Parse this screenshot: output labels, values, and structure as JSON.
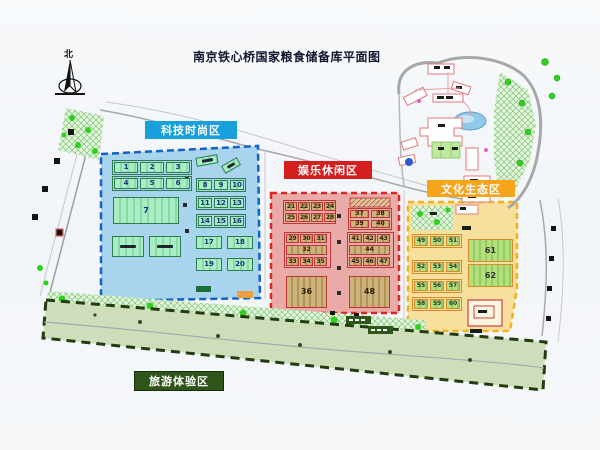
{
  "title": "南京铁心桥国家粮食储备库平面图",
  "compass": {
    "label": "北"
  },
  "map_colors": {
    "tech_zone_fill": "#a8d4ee",
    "tech_border": "#1461c8",
    "tech_accent": "#18a0dc",
    "fun_zone_fill": "#e9aaa8",
    "fun_border": "#e02424",
    "fun_accent": "#d51e1e",
    "culture_zone_fill": "#f7df9e",
    "culture_border": "#f2b21c",
    "culture_accent": "#f6a41c",
    "tour_zone_fill": "#cfdeba",
    "tour_border": "#223c10",
    "tour_accent": "#2e561b",
    "block_green": "#a9eec3",
    "block_tan": "#ccb37b",
    "pond_blue": "#8fc8e8",
    "tree_green": "#2fd11f"
  },
  "zones": {
    "tech": {
      "label": "科技时尚区",
      "accent": "#18a0dc",
      "groups": {
        "row1": [
          "1",
          "2",
          "3"
        ],
        "row2": [
          "4",
          "5",
          "6"
        ],
        "big": [
          "7"
        ],
        "special": [
          "",
          ""
        ],
        "r8": [
          "8",
          "9",
          "10"
        ],
        "r11": [
          "11",
          "12",
          "13"
        ],
        "r14": [
          "14",
          "15",
          "16"
        ],
        "r17": [
          "17",
          "18"
        ],
        "r19": [
          "19",
          "20"
        ],
        "tilt1": [
          ""
        ],
        "tilt2": [
          ""
        ]
      }
    },
    "fun": {
      "label": "娱乐休闲区",
      "accent": "#d51e1e",
      "groups": {
        "tl1": [
          "21",
          "22",
          "23",
          "24"
        ],
        "tl2": [
          "25",
          "26",
          "27",
          "28"
        ],
        "tr1": [
          "37",
          "38"
        ],
        "tr2": [
          "39",
          "40"
        ],
        "ml1": [
          "29",
          "30",
          "31"
        ],
        "ml2": [
          "32"
        ],
        "ml3": [
          "33",
          "34",
          "35"
        ],
        "mr1": [
          "41",
          "42",
          "43"
        ],
        "mr2": [
          "44"
        ],
        "mr3": [
          "45",
          "46",
          "47"
        ],
        "b36": [
          "36"
        ],
        "b48": [
          "48"
        ]
      }
    },
    "culture": {
      "label": "文化生态区",
      "accent": "#f6a41c",
      "groups": {
        "r1": [
          "49",
          "50",
          "51"
        ],
        "r2": [
          "52",
          "53",
          "54"
        ],
        "r3": [
          "55",
          "56",
          "57"
        ],
        "r4": [
          "58",
          "59",
          "60"
        ],
        "b61": [
          "61"
        ],
        "b62": [
          "62"
        ]
      }
    },
    "tour": {
      "label": "旅游体验区",
      "accent": "#2e561b"
    }
  }
}
